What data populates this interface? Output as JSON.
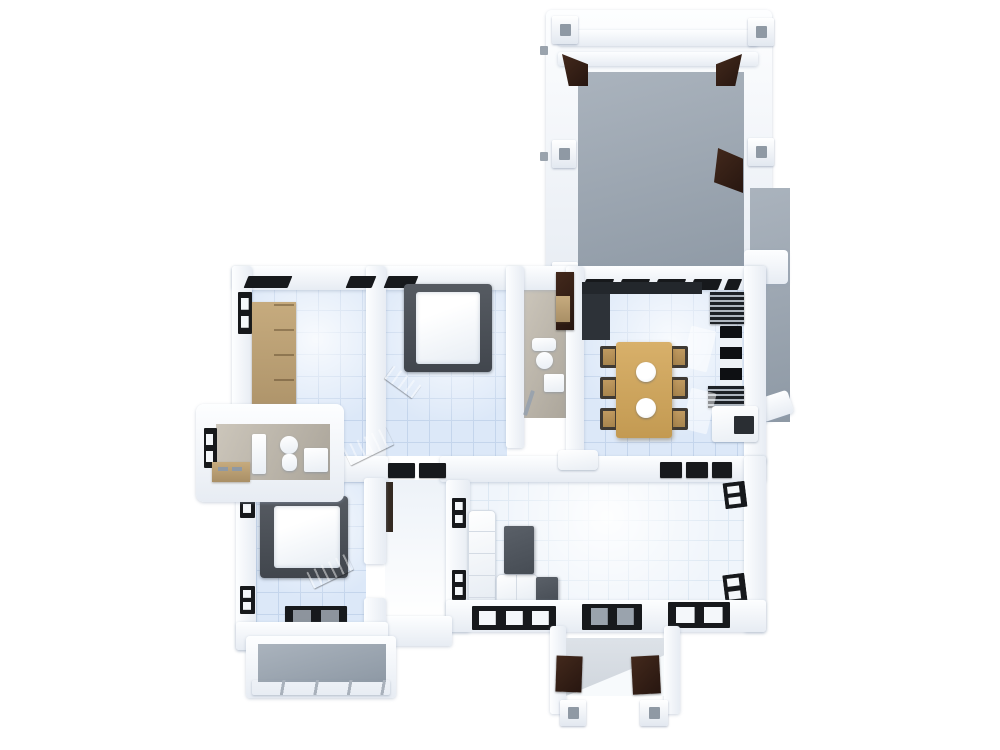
{
  "scene": {
    "description": "3D rendered top-down floor plan of a furnished apartment on a white background",
    "view": "top-down axonometric render",
    "rooms": [
      {
        "id": "garage-terrace",
        "position": "top-right",
        "floor": "gray",
        "features": [
          "corner-columns",
          "dark-wood-door-panels",
          "side-terrace-strip"
        ]
      },
      {
        "id": "bedroom-upper-left",
        "position": "upper-left",
        "floor": "blue-tile",
        "features": [
          "wooden-wardrobe",
          "left-window",
          "window-headers"
        ]
      },
      {
        "id": "bedroom-upper-middle",
        "position": "upper-middle",
        "floor": "blue-tile",
        "features": [
          "double-bed-dark-frame",
          "gray-bench"
        ]
      },
      {
        "id": "bathroom-middle",
        "position": "center",
        "floor": "beige",
        "features": [
          "toilet",
          "sink",
          "dark-door",
          "wood-shelf"
        ]
      },
      {
        "id": "dining-kitchen",
        "position": "center-right",
        "floor": "blue-tile",
        "features": [
          "wooden-dining-table",
          "six-chairs",
          "two-plates",
          "dark-kitchen-counter",
          "wall-shelves",
          "white-cabinet"
        ]
      },
      {
        "id": "bathroom-left",
        "position": "left-protrusion",
        "floor": "beige",
        "features": [
          "toilet",
          "sink",
          "tub",
          "wood-counter",
          "left-window"
        ]
      },
      {
        "id": "bedroom-lower-left",
        "position": "lower-left",
        "floor": "blue-tile",
        "features": [
          "double-bed-dark-frame",
          "striped-rug",
          "left-windows"
        ]
      },
      {
        "id": "hallway",
        "position": "center",
        "floor": "white",
        "features": [
          "door-mats",
          "diagonal-gray-mats",
          "door-leaf"
        ]
      },
      {
        "id": "living-room",
        "position": "bottom-right",
        "floor": "white-tile",
        "features": [
          "l-shaped-white-sofa",
          "coffee-table",
          "side-table",
          "corner-windows",
          "bottom-windows"
        ]
      },
      {
        "id": "balcony",
        "position": "bottom-left",
        "floor": "gray",
        "features": [
          "railing"
        ]
      },
      {
        "id": "entry-porch",
        "position": "bottom-center",
        "floor": "white-steps",
        "features": [
          "brown-bench-left",
          "brown-bench-right",
          "two-columns"
        ]
      }
    ]
  },
  "colors": {
    "canvas": "#ffffff",
    "wall_hi": "#fdfeff",
    "wall_lo": "#e7ecf3",
    "tile_blue": "#dce8f8",
    "tile_blue_line": "#c4d5ec",
    "tile_white": "#f0f5fb",
    "tile_white_line": "#dde8f3",
    "gray_hi": "#aab3bd",
    "gray_lo": "#8e99a5",
    "beige_hi": "#ccc6bb",
    "beige_lo": "#aba59a",
    "wood_hi": "#c6ab7e",
    "wood_lo": "#a98f66",
    "table_hi": "#d8b06a",
    "table_lo": "#c39a52",
    "furn_hi": "#5a6068",
    "furn_lo": "#464c54",
    "bed_hi": "#565b62",
    "bed_lo": "#41464d",
    "near_black": "#17191c",
    "brown_hi": "#43291c",
    "brown_lo": "#271610",
    "mat_hi": "#a8afb8",
    "mat_lo": "#8d949d"
  }
}
